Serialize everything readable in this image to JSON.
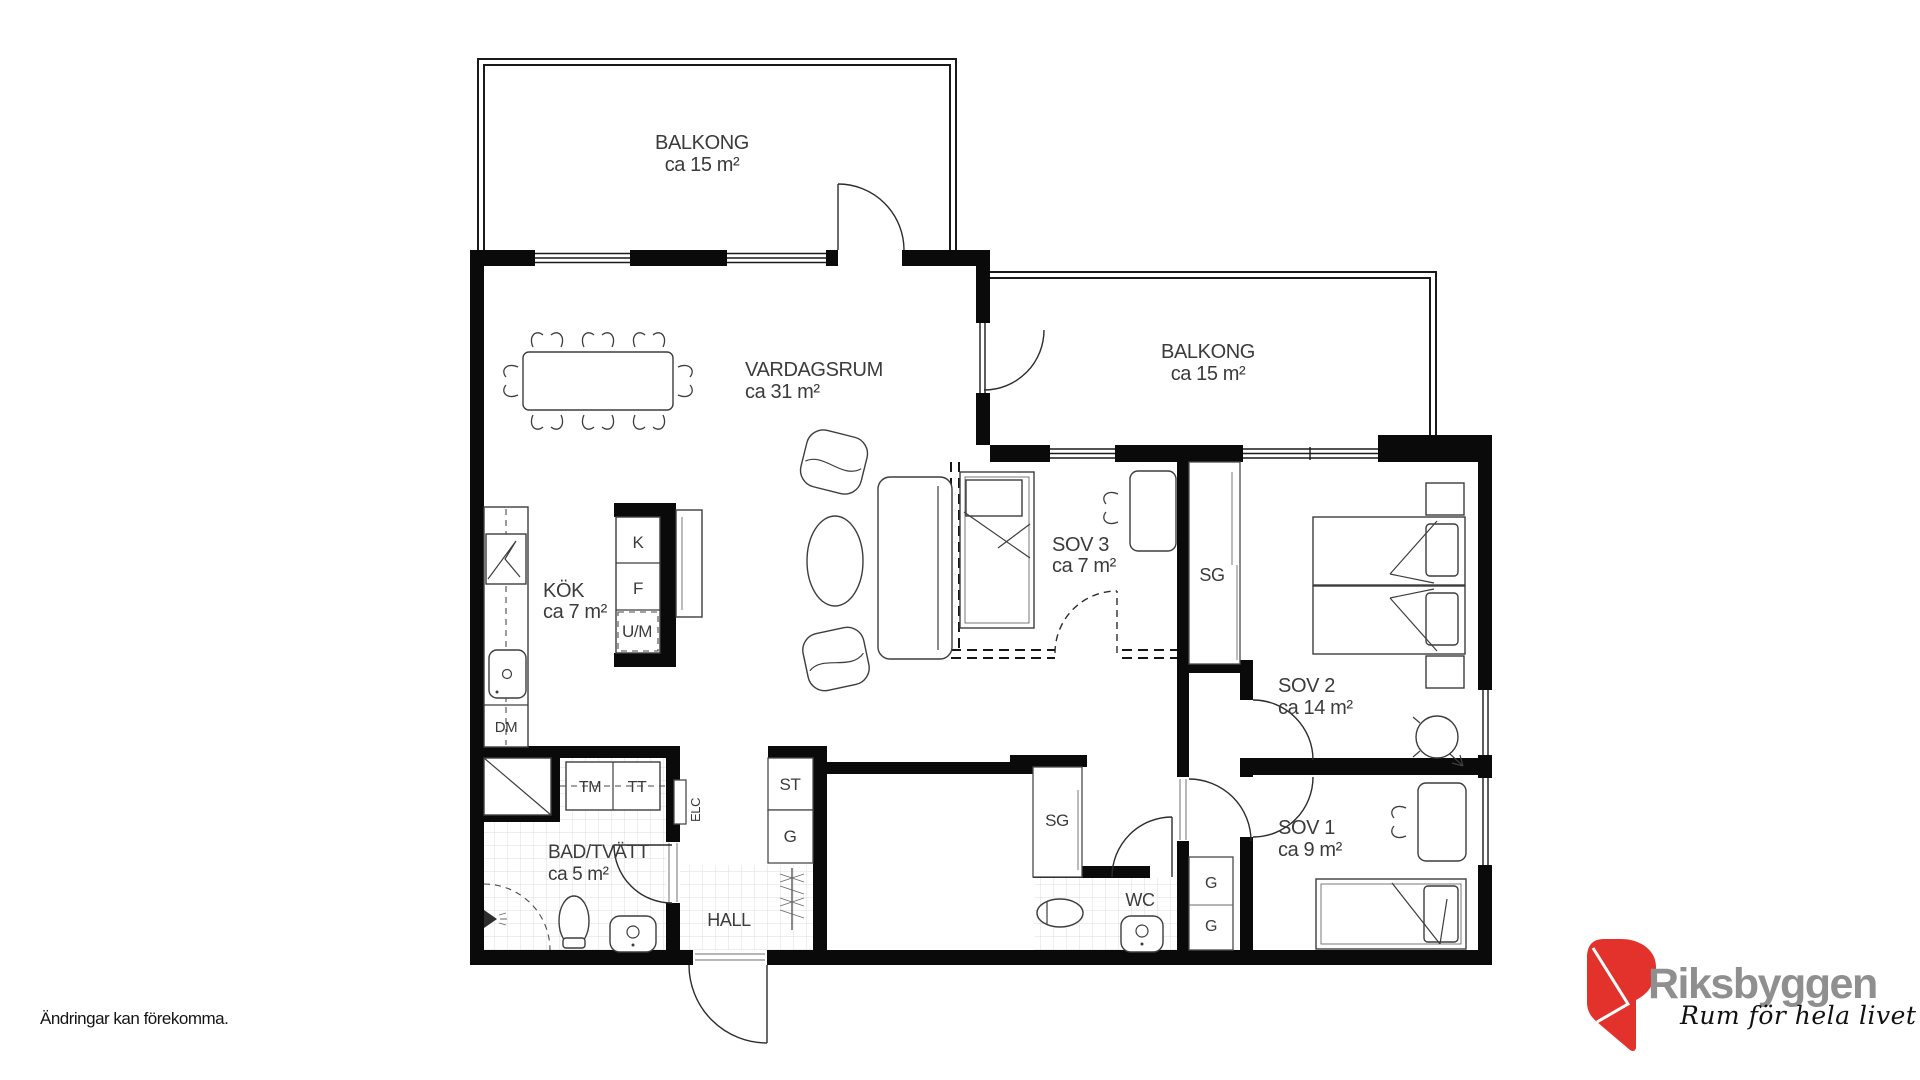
{
  "disclaimer": "Ändringar kan förekomma.",
  "logo": {
    "name": "Riksbyggen",
    "tagline": "Rum för hela livet",
    "brand_red": "#E3312B",
    "brand_gray": "#8F8F8F"
  },
  "floorplan": {
    "rooms": {
      "balcony_top": {
        "name": "BALKONG",
        "area": "ca 15 m²"
      },
      "balcony_right": {
        "name": "BALKONG",
        "area": "ca 15 m²"
      },
      "living": {
        "name": "VARDAGSRUM",
        "area": "ca 31 m²"
      },
      "kitchen": {
        "name": "KÖK",
        "area": "ca 7 m²"
      },
      "bedroom3": {
        "name": "SOV 3",
        "area": "ca 7 m²"
      },
      "bedroom2": {
        "name": "SOV 2",
        "area": "ca 14 m²"
      },
      "bedroom1": {
        "name": "SOV 1",
        "area": "ca 9 m²"
      },
      "bath": {
        "name": "BAD/TVÄTT",
        "area": "ca 5 m²"
      },
      "hall": {
        "name": "HALL"
      },
      "wc": {
        "name": "WC"
      }
    },
    "fixtures": {
      "fridge": "K",
      "freezer": "F",
      "oven_micro": "U/M",
      "dishwasher": "DM",
      "washer": "TM",
      "dryer": "TT",
      "electrical": "ELC",
      "cleaning_closet": "ST",
      "hall_wardrobe": "G",
      "hall_sliding": "SG",
      "bedroom_sliding": "SG",
      "wardrobe_upper": "G",
      "wardrobe_lower": "G"
    }
  }
}
